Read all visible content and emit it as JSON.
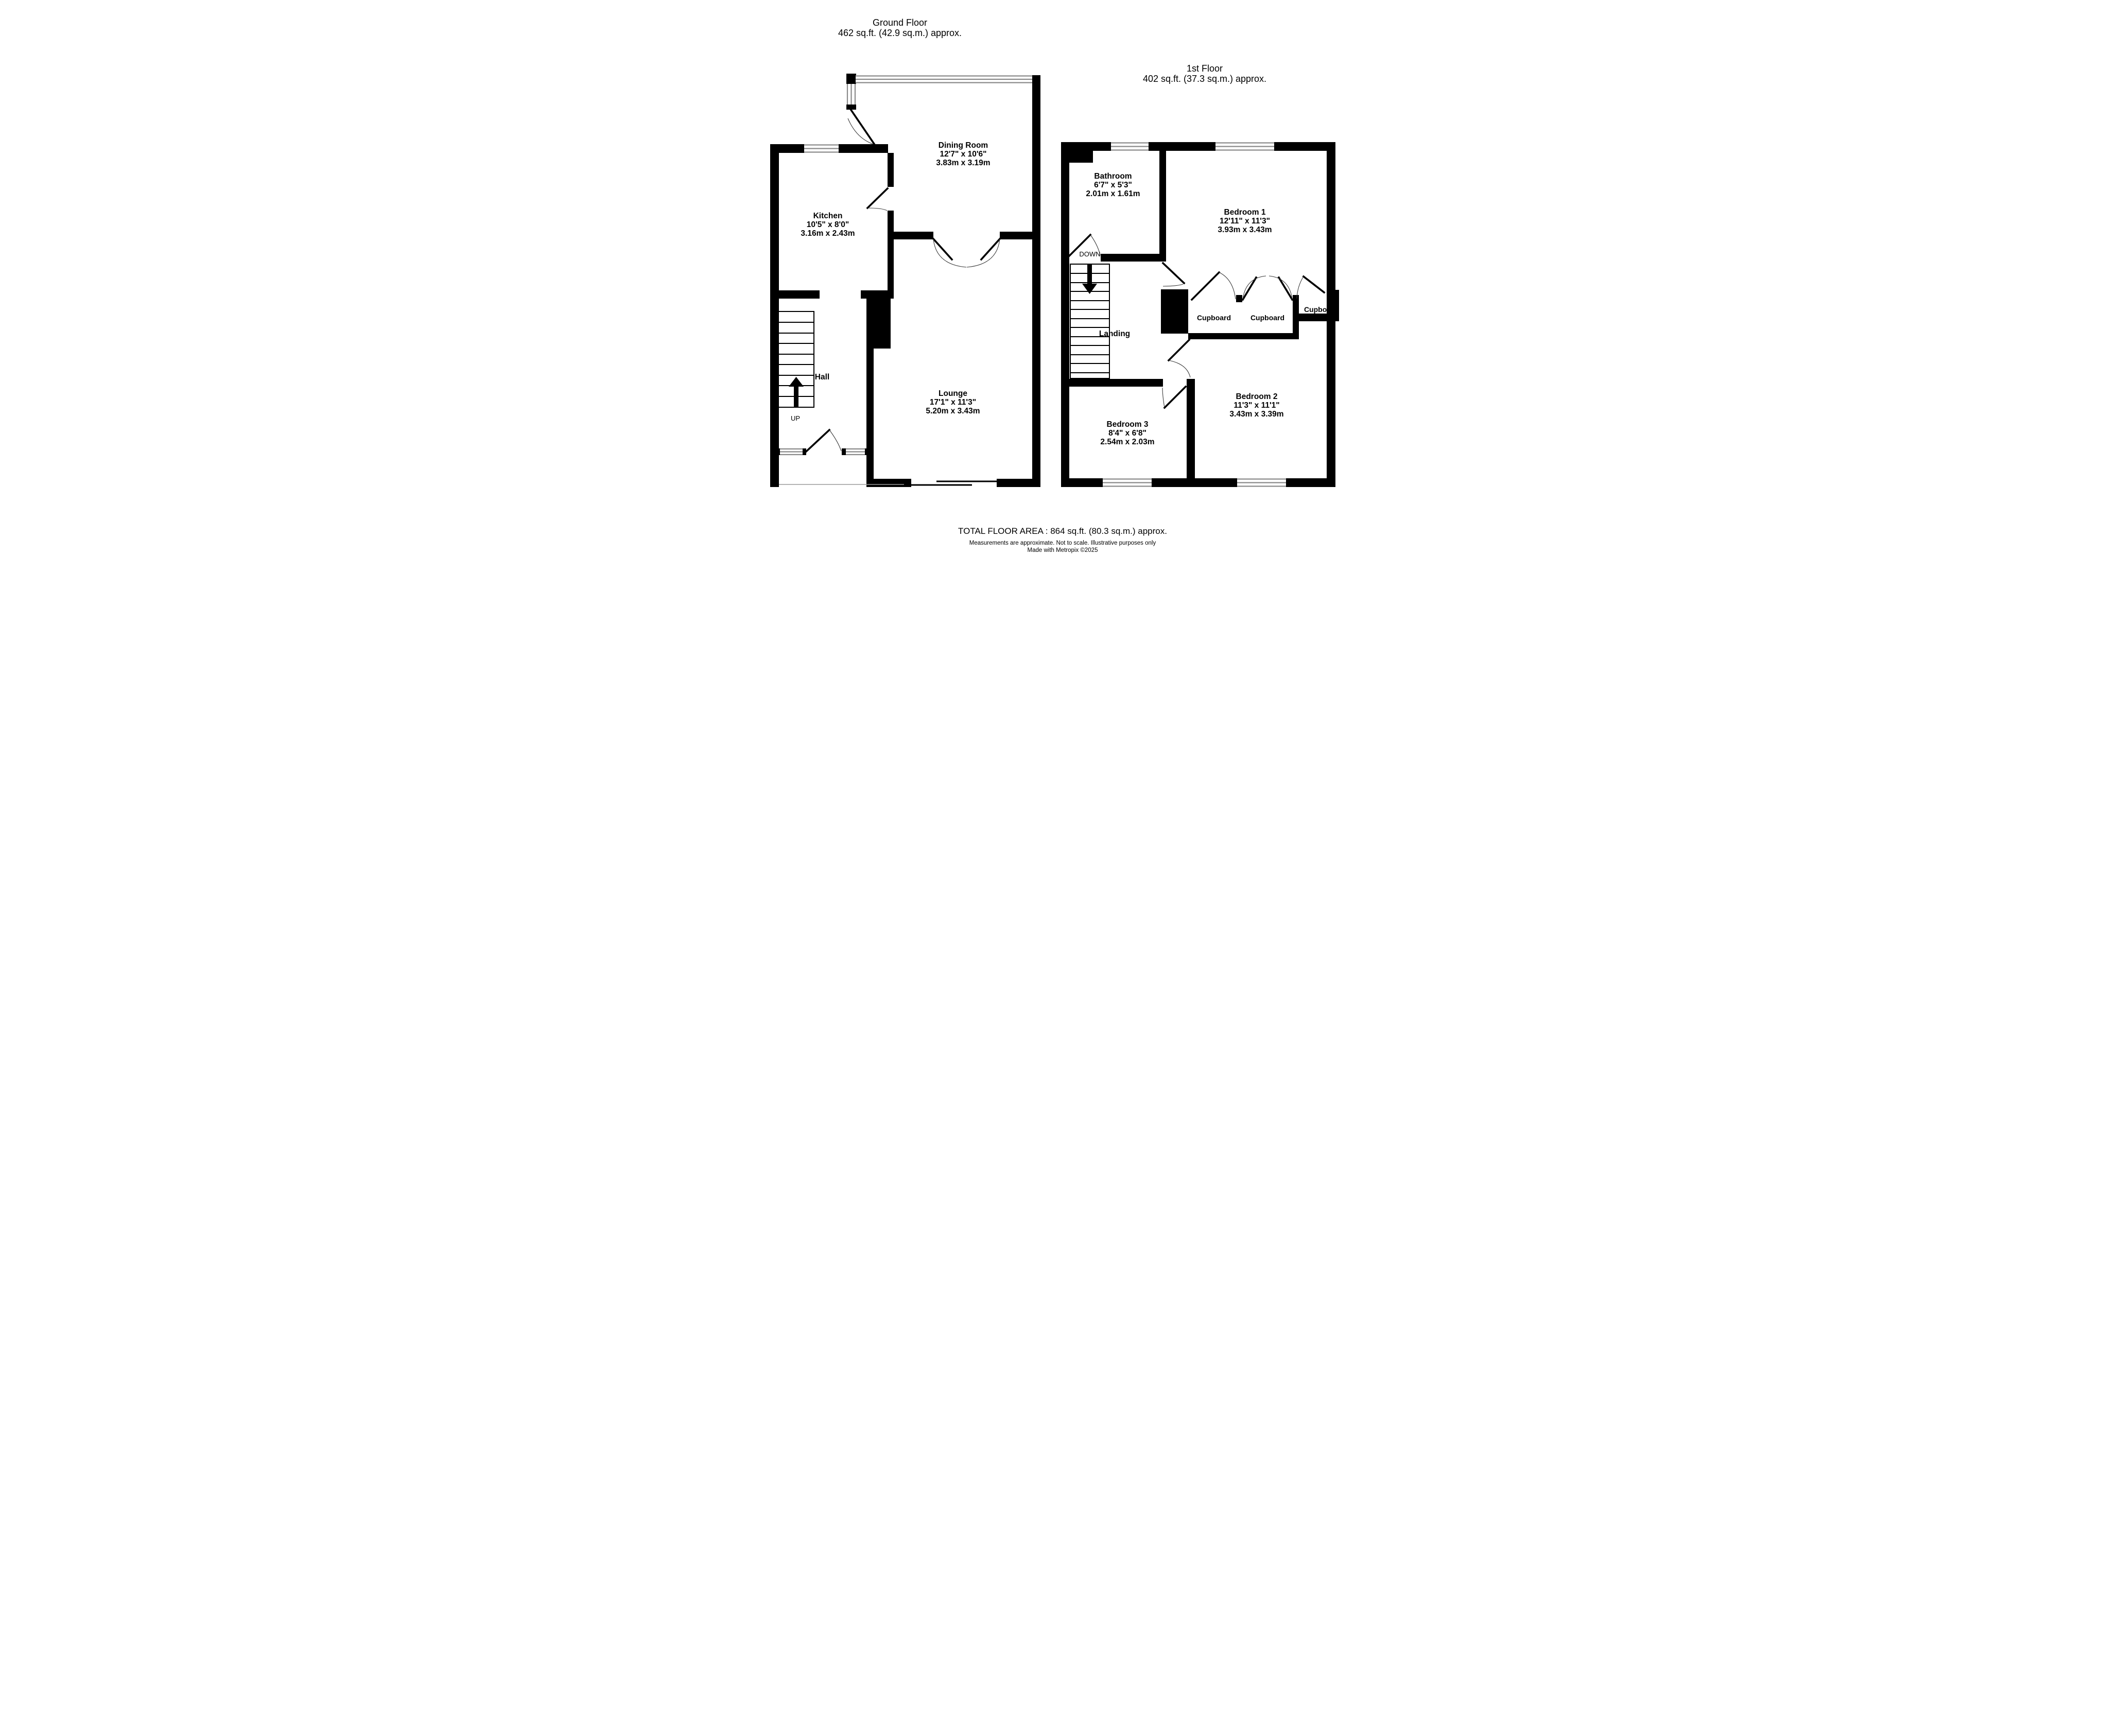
{
  "colors": {
    "background": "#ffffff",
    "wall": "#000000",
    "window_frame_line": "#8a8a8a",
    "door_swing": "#3a3a3a"
  },
  "ground_floor": {
    "title": "Ground Floor",
    "area": "462 sq.ft. (42.9 sq.m.) approx.",
    "rooms": {
      "dining_room": {
        "name": "Dining Room",
        "size_imperial": "12'7\"  x 10'6\"",
        "size_metric": "3.83m  x 3.19m"
      },
      "kitchen": {
        "name": "Kitchen",
        "size_imperial": "10'5\"  x 8'0\"",
        "size_metric": "3.16m  x 2.43m"
      },
      "lounge": {
        "name": "Lounge",
        "size_imperial": "17'1\"  x 11'3\"",
        "size_metric": "5.20m  x 3.43m"
      },
      "hall": {
        "name": "Hall"
      }
    },
    "stairs_label": "UP"
  },
  "first_floor": {
    "title": "1st Floor",
    "area": "402 sq.ft. (37.3 sq.m.) approx.",
    "rooms": {
      "bathroom": {
        "name": "Bathroom",
        "size_imperial": "6'7\"  x 5'3\"",
        "size_metric": "2.01m  x 1.61m"
      },
      "bedroom1": {
        "name": "Bedroom 1",
        "size_imperial": "12'11\"  x 11'3\"",
        "size_metric": "3.93m  x 3.43m"
      },
      "bedroom2": {
        "name": "Bedroom 2",
        "size_imperial": "11'3\"  x 11'1\"",
        "size_metric": "3.43m  x 3.39m"
      },
      "bedroom3": {
        "name": "Bedroom 3",
        "size_imperial": "8'4\"  x 6'8\"",
        "size_metric": "2.54m  x 2.03m"
      },
      "landing": {
        "name": "Landing"
      },
      "cupboard": {
        "name": "Cupboard"
      }
    },
    "stairs_label": "DOWN"
  },
  "footer": {
    "total": "TOTAL FLOOR AREA : 864 sq.ft. (80.3 sq.m.) approx.",
    "disclaimer": "Measurements are approximate.  Not to scale.  Illustrative purposes only",
    "credit": "Made with Metropix ©2025"
  }
}
